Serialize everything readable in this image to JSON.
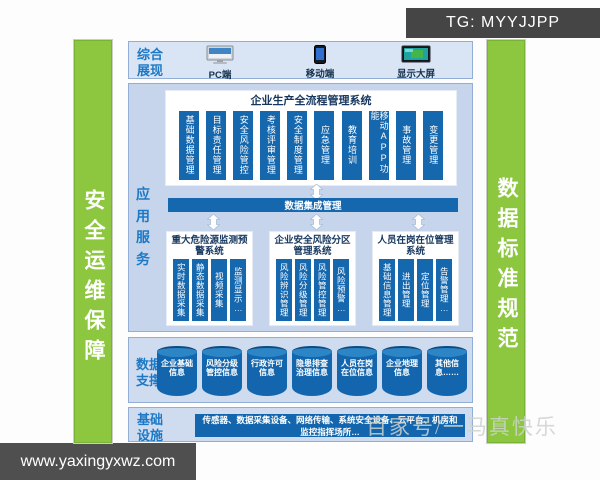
{
  "watermarks": {
    "tg_badge": "TG: MYYJJPP",
    "site_badge": "www.yaxingyxwz.com",
    "faint_text": "百家号/一马真快乐"
  },
  "pillars": {
    "left": "安全运维保障",
    "right": "数据标准规范"
  },
  "display": {
    "label": "综合展现",
    "devices": [
      {
        "name": "PC端",
        "icon": "pc-icon"
      },
      {
        "name": "移动端",
        "icon": "mobile-icon"
      },
      {
        "name": "显示大屏",
        "icon": "bigscreen-icon"
      }
    ]
  },
  "application": {
    "label": "应用服务",
    "process_system": {
      "title": "企业生产全流程管理系统",
      "modules": [
        "基础数据管理",
        "目标责任管理",
        "安全风险管控",
        "考核评审管理",
        "安全制度管理",
        "应急管理",
        "教育培训",
        "移动APP功能",
        "事故管理",
        "变更管理"
      ]
    },
    "integration": "数据集成管理",
    "subsystems": [
      {
        "title": "重大危险源监测预警系统",
        "modules": [
          "实时数据采集",
          "静态数据采集",
          "视频采集",
          "监测显示…"
        ]
      },
      {
        "title": "企业安全风险分区管理系统",
        "modules": [
          "风险辨识管理",
          "风险分级管理",
          "风险管控管理",
          "风险预警…"
        ]
      },
      {
        "title": "人员在岗在位管理系统",
        "modules": [
          "基础信息管理",
          "进出管理",
          "定位管理",
          "告警管理…"
        ]
      }
    ]
  },
  "data_support": {
    "label": "数据支撑",
    "databases": [
      "企业基础信息",
      "风险分级管控信息",
      "行政许可信息",
      "隐患排查治理信息",
      "人员在岗在位信息",
      "企业地理信息",
      "其他信息……"
    ]
  },
  "infrastructure": {
    "label": "基础设施",
    "items": "传感器、数据采集设备、网络传输、系统安全设备、云平台、机房和监控指挥场所…"
  },
  "colors": {
    "pillar_green": "#8dc73f",
    "bar_blue": "#1567ae",
    "panel_blue": "#cfdcf0",
    "label_blue": "#1d79c6",
    "title_navy": "#17375e"
  }
}
